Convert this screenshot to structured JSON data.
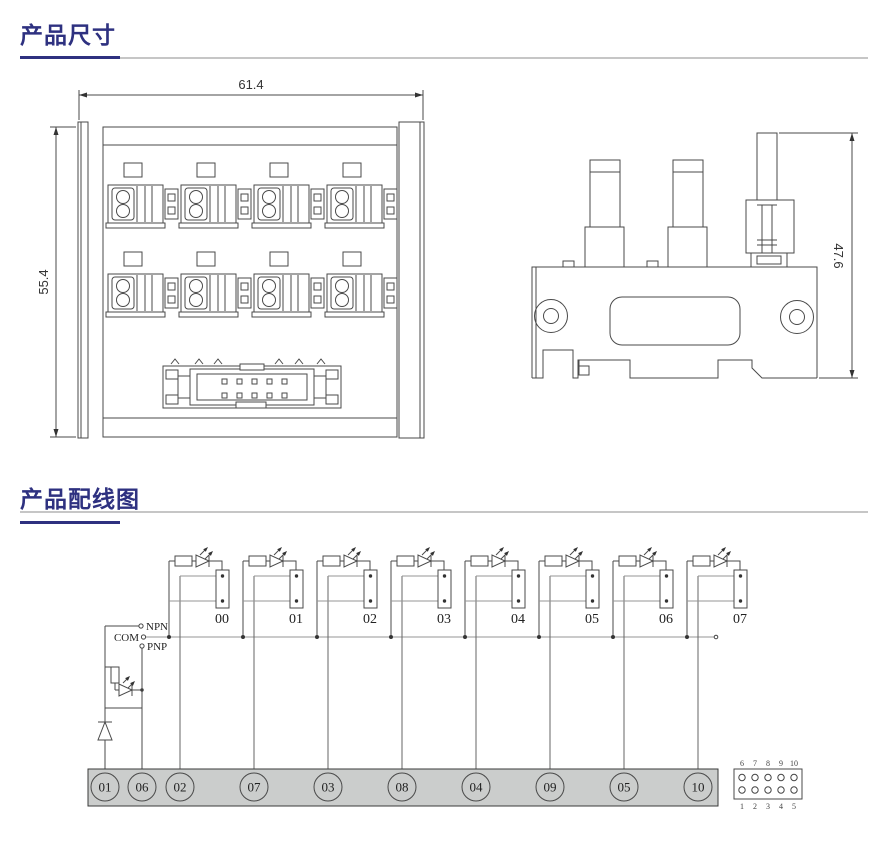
{
  "sections": {
    "dimensions": {
      "title": "产品尺寸"
    },
    "wiring": {
      "title": "产品配线图"
    }
  },
  "dims": {
    "front_width": "61.4",
    "front_height": "55.4",
    "side_height": "47.6"
  },
  "wiring": {
    "bus_labels": {
      "npn": "NPN",
      "com": "COM",
      "pnp": "PNP"
    },
    "channels": [
      "00",
      "01",
      "02",
      "03",
      "04",
      "05",
      "06",
      "07"
    ],
    "terminals": [
      "01",
      "06",
      "02",
      "07",
      "03",
      "08",
      "04",
      "09",
      "05",
      "10"
    ],
    "connector_pins": {
      "top": [
        "6",
        "7",
        "8",
        "9",
        "10"
      ],
      "bottom": [
        "1",
        "2",
        "3",
        "4",
        "5"
      ]
    }
  },
  "colors": {
    "title": "#2e3180",
    "title_rule_gray": "#c6c6c6",
    "drawing_line": "#4a4a4a",
    "wire_gray": "#949494",
    "strip_fill": "#cbcdcc"
  }
}
